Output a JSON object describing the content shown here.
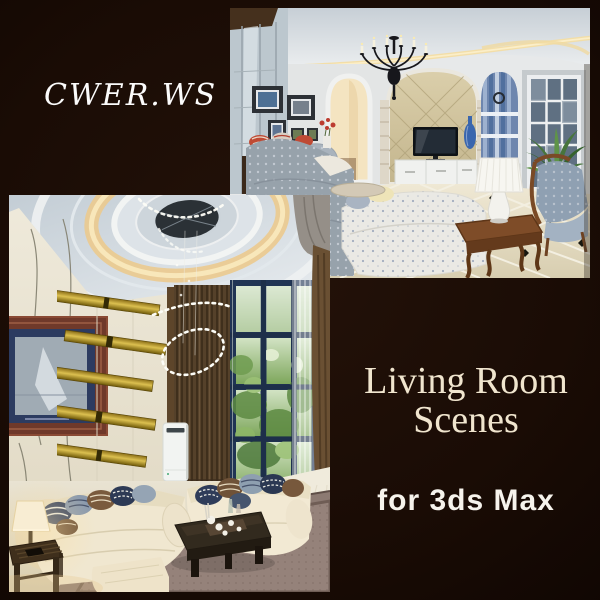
{
  "page": {
    "kind": "promo-cover",
    "background_color": "#180C06"
  },
  "watermark": {
    "text": "CWER.WS",
    "color": "#FBFBFB"
  },
  "title": {
    "line1": "Living Room",
    "line2": "Scenes",
    "color": "#F0E5CE"
  },
  "subtitle": {
    "text": "for 3ds Max",
    "color": "#F6F3EC"
  },
  "photos": {
    "top_right": {
      "name": "classic-living-room-photo",
      "description": "Classic living room render: black candle chandelier, cove-lit tray ceiling, framed pictures, glass cabinet, arched doorway, beige stone TV wall with television and white media cabinet, blue striped arched niche, tall window with potted plant, patterned grey-blue sofas, wooden coffee table with white pleated lamp, beige diagonal tile floor with black diamond insets"
    },
    "bottom_left": {
      "name": "modern-living-room-photo",
      "description": "Modern double-height living room render: circular tray ceiling with warm cove light and beaded spiral chandelier, cream panel wall with gold mirror stripes, framed artwork, dark brown slat curtain, tall navy-framed window with greenery, cream sofas with striped pillows, dark wood coffee table with tea set, mauve rug, floor AC unit, glowing side-table lamp"
    }
  }
}
